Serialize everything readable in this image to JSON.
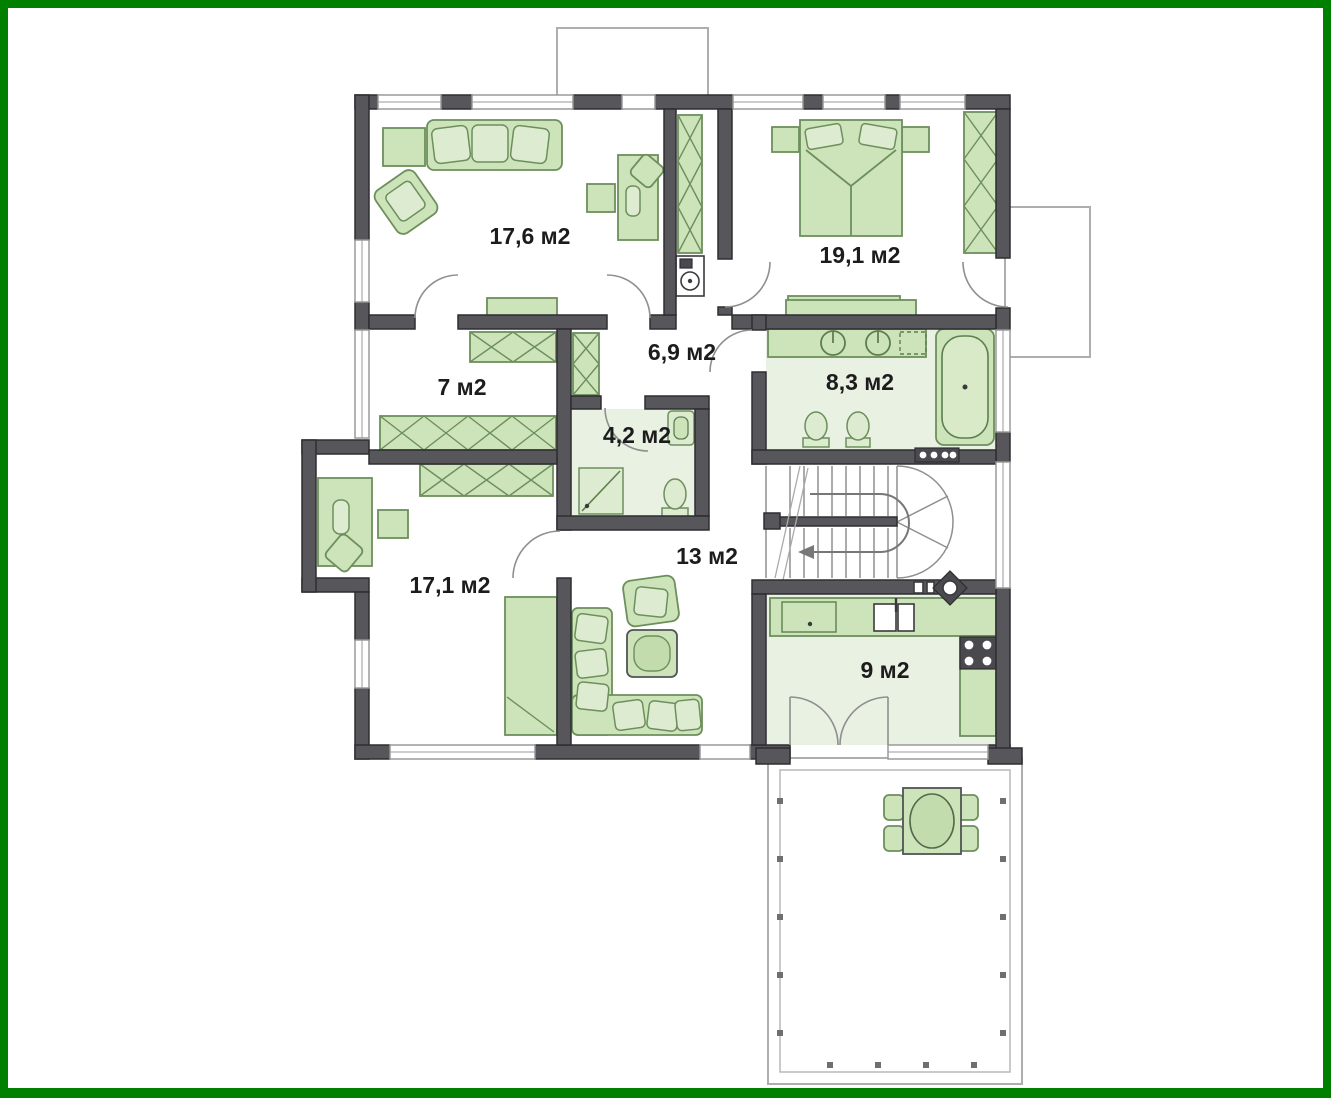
{
  "plan": {
    "type": "floor-plan",
    "unit_suffix": "м2",
    "rooms": [
      {
        "id": "living-room",
        "label": "17,6 м2"
      },
      {
        "id": "bedroom",
        "label": "19,1 м2"
      },
      {
        "id": "hallway",
        "label": "6,9 м2"
      },
      {
        "id": "wardrobe-room",
        "label": "7 м2"
      },
      {
        "id": "bathroom",
        "label": "8,3 м2"
      },
      {
        "id": "shower-room",
        "label": "4,2 м2"
      },
      {
        "id": "sitting-room",
        "label": "13 м2"
      },
      {
        "id": "study",
        "label": "17,1 м2"
      },
      {
        "id": "kitchen",
        "label": "9 м2"
      }
    ],
    "colors": {
      "frame_green": "#008000",
      "wall_gray": "#57575b",
      "furniture_green": "#cde4ba",
      "furniture_outline": "#6d8f5c",
      "floor_tint": "#e9f1e3",
      "label_text": "#1c1c1c"
    }
  }
}
